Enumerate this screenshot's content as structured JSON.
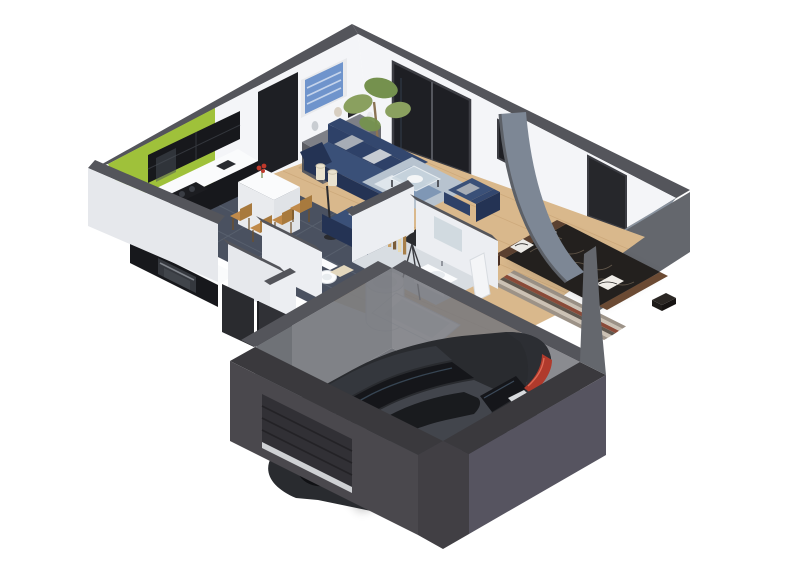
{
  "scene": {
    "type": "isometric-3d-cutaway-floor-plan-render",
    "background": "#ffffff",
    "rooms": [
      {
        "name": "kitchen",
        "features": [
          "lime-green accent wall",
          "dark gloss upper cabinets",
          "dark base cabinets with white worktop",
          "built-in oven",
          "cooktop",
          "white breakfast peninsula",
          "4 wooden bar chairs",
          "dark slate tile floor",
          "red flowers in vase"
        ]
      },
      {
        "name": "living-room",
        "features": [
          "navy three-seat sofa with gray cushions",
          "navy two-seat sofa",
          "navy armchair",
          "blue patterned rug",
          "glass coffee table with white tray",
          "gray sideboard with bust and vases",
          "blue abstract wall art",
          "potted ficus tree",
          "twin cream floor lamp",
          "tripod floor lamp",
          "wood slat screen",
          "oak plank floor",
          "dark sliding glass door",
          "small window"
        ]
      },
      {
        "name": "bedroom",
        "features": [
          "double bed with dark patterned duvet",
          "wood headboard",
          "black-and-white pillows",
          "striped rug",
          "curved gray feature wall",
          "gray-blue accent wall",
          "dark door",
          "small bench",
          "bedside box"
        ]
      },
      {
        "name": "bathroom",
        "features": [
          "cylindrical shower cabin",
          "wall-mounted washbasin",
          "mirror",
          "bathtub",
          "toilet",
          "open white door"
        ]
      },
      {
        "name": "entry-hall",
        "features": [
          "white closet partitions",
          "dark front door",
          "dark storage niche",
          "doormat",
          "oak floor"
        ]
      },
      {
        "name": "garage",
        "features": [
          "dark full-height walls",
          "concrete floor",
          "sectional garage door",
          "dark gray hatchback car"
        ]
      }
    ]
  },
  "palette": {
    "bg": "#ffffff",
    "band": "#54555b",
    "wall-lit": "#f4f5f8",
    "wall-mid": "#eceef2",
    "wall-ext": "#e6e8ec",
    "green": "#9fc13a",
    "glass": "#1e1f24",
    "frame": "#3c3d43",
    "wood": "#d9b88c",
    "wood-line": "#c49e6f",
    "tile": "#4a5160",
    "tile-line": "#5e6673",
    "navy": "#2e4168",
    "navy-dark": "#243354",
    "navy-top": "#33476e",
    "navy-seat": "#3a5078",
    "cushion": "#a7adb6",
    "cushion-light": "#c6cbd2",
    "rug": "#b7c3cf",
    "rug-med": "#8fa5bd",
    "rug-dark": "#7f97b5",
    "glass-table": "#cdd9e1",
    "sideboard": "#6b6c72",
    "sideboard-top": "#7e8087",
    "sideboard-side": "#5b5c62",
    "plant": "#8aa05f",
    "plant-dark": "#75914e",
    "pot": "#3f362e",
    "art-blue": "#6f94cc",
    "art-light": "#cfdcef",
    "part-gray": "#8b95a1",
    "part-curve": "#7d8795",
    "bed-dark": "#23201e",
    "bed-line": "#6e6253",
    "headboard": "#5a4030",
    "bed-frame": "#6b4a33",
    "pillow": "#eceae6",
    "stripe1": "#9c9287",
    "stripe2": "#cbc1b4",
    "stripe3": "#5f574e",
    "stripe4": "#8a4a38",
    "bath-white": "#fbfcfd",
    "bath-shade": "#d9dee3",
    "bath-floor": "#d8dde2",
    "garage-wall": "#4a484d",
    "garage-band": "#3a393d",
    "garage-wall-light": "#565460",
    "concrete": "#75777d",
    "car-body": "#292b2f",
    "car-mid": "#3b3e44",
    "car-roof": "#42454c",
    "car-glass": "#15161a",
    "tail-red": "#b03a2c",
    "wheel": "#101114",
    "rim": "#585b61",
    "stool": "#c08a4a",
    "stool-dark": "#6e4f28",
    "counter": "#fafbfc",
    "counter-side": "#e9ebee",
    "cab-dark": "#17181c",
    "oven": "#35383e",
    "white-door": "#f4f5f7",
    "ext-face": "#64676d",
    "lamp-cream": "#e9e2cf",
    "red-flower": "#c0392b"
  }
}
